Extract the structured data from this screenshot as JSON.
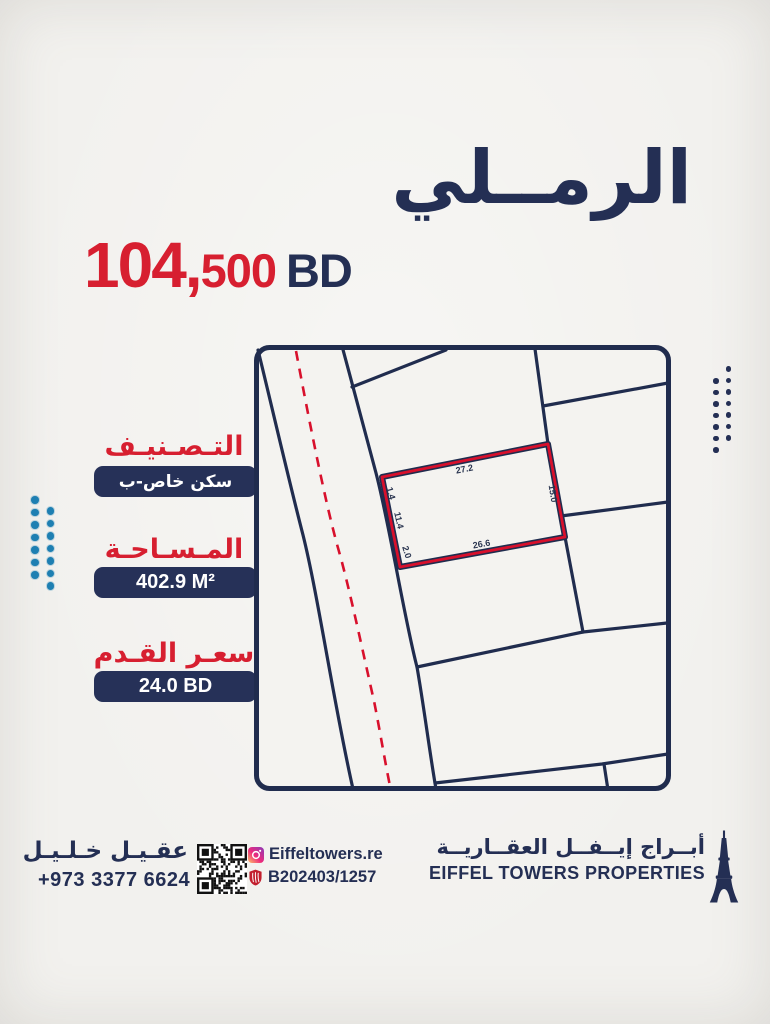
{
  "colors": {
    "navy": "#242f54",
    "red": "#d71f30",
    "teal": "#1e7fb2",
    "paper": "#f2f1ee",
    "map_line": "#202c4e",
    "parcel_red": "#d8102c"
  },
  "title": "الرمــلي",
  "price": {
    "amount_major": "104,",
    "amount_minor": "500",
    "currency": "BD"
  },
  "specs": {
    "classification": {
      "label": "التـصـنيـف",
      "value": "سكن خاص-ب"
    },
    "area": {
      "label": "المـسـاحـة",
      "value": "402.9 M²"
    },
    "price_per_foot": {
      "label": "سعـر القـدم",
      "value": "24.0 BD"
    }
  },
  "map": {
    "dims": {
      "top": "27.2",
      "right": "15.0",
      "bottom": "26.6",
      "left_top": "1.4",
      "left_mid": "11.4",
      "left_bottom": "2.0"
    }
  },
  "footer": {
    "agent_name": "عقـيـل خـلـيـل",
    "phone": "+973 3377 6624",
    "instagram_handle": "Eiffeltowers.re",
    "registration": "B202403/1257",
    "company_name_ar": "أبــراج إيــفــل العقــاريــة",
    "company_name_en": "EIFFEL TOWERS PROPERTIES"
  }
}
